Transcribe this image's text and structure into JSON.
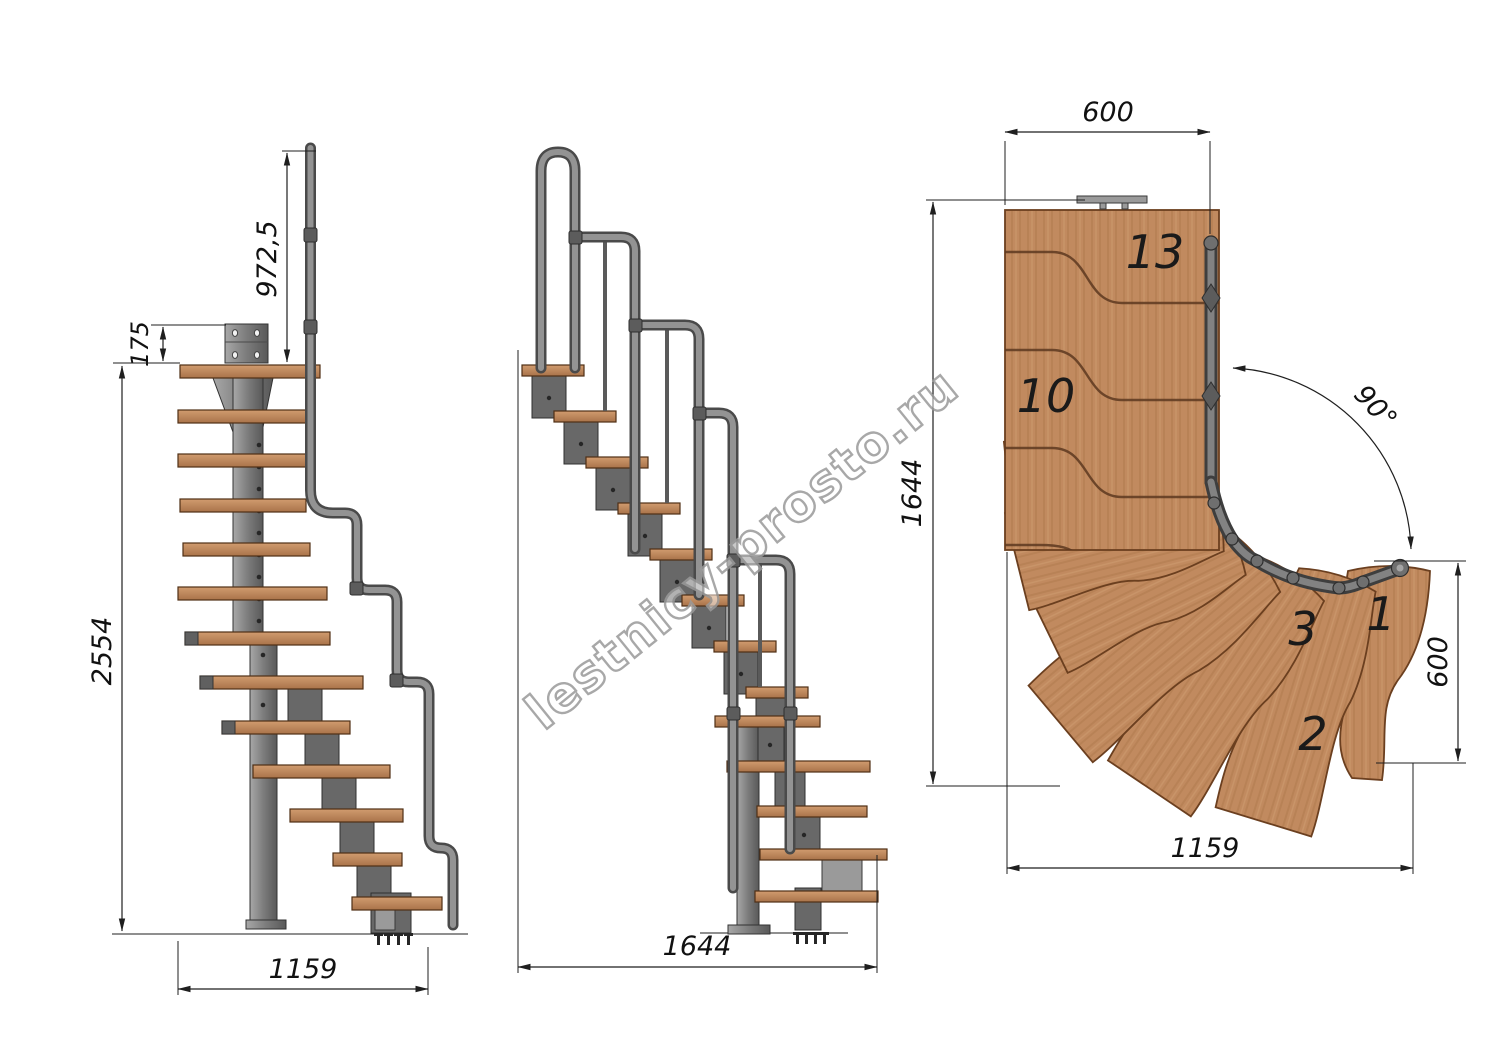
{
  "watermark": {
    "text": "lestnicy-prosto.ru"
  },
  "colors": {
    "wood": "#c18a5f",
    "wood_edge": "#6b3f1f",
    "tread_light": "#d19c6f",
    "tread_dark": "#a9734a",
    "metal_light": "#a8a8a8",
    "metal_dark": "#595959",
    "line": "#1f1f1f",
    "watermark_gray": "#9a9a9a"
  },
  "front_view": {
    "dims": {
      "rail_height": "972,5",
      "plate_offset": "175",
      "total_height": "2554",
      "width": "1159"
    }
  },
  "side_view": {
    "dims": {
      "length": "1644"
    }
  },
  "plan_view": {
    "dims": {
      "top_width": "600",
      "side_height": "1644",
      "turn_angle": "90°",
      "exit_width": "600",
      "bottom_length": "1159"
    },
    "steps": {
      "s13": "13",
      "s10": "10",
      "s3": "3",
      "s1": "1",
      "s2": "2"
    }
  }
}
